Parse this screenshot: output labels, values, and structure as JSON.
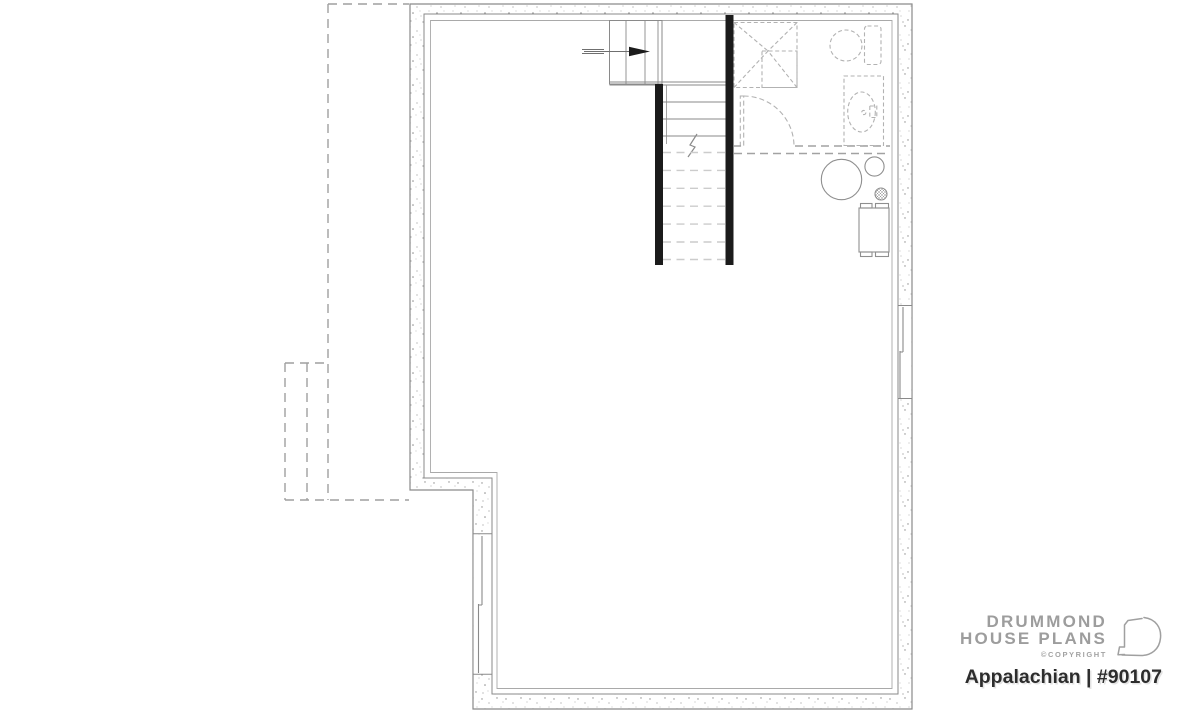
{
  "page": {
    "background_color": "#ffffff"
  },
  "plan": {
    "name": "basement-floor-plan",
    "colors": {
      "wall_line": "#8a8a8a",
      "wall_stipple": "#8f8f8f",
      "stair_wall_black": "#1b1b1b",
      "dashed_fixture": "#b2b2b2",
      "dashed_outline": "#9f9f9f",
      "light_dashed_tread": "#cccccc"
    },
    "elements": [
      "exterior-walls",
      "porch-outline-dashed",
      "staircase",
      "stair-direction-arrow",
      "shower-dashed",
      "door-swing-dashed",
      "toilet-dashed",
      "vanity-sink-dashed",
      "water-heater-circle",
      "small-tank-circle",
      "floor-drain",
      "electrical-panel",
      "window-left",
      "window-right"
    ],
    "stairs": {
      "solid_treads": 3,
      "dashed_treads": 7
    }
  },
  "brand": {
    "line1": "DRUMMOND",
    "line2": "HOUSE PLANS",
    "copyright": "©COPYRIGHT",
    "logo_icon": "drummond-d-logo"
  },
  "title": {
    "text": "Appalachian | #90107"
  }
}
